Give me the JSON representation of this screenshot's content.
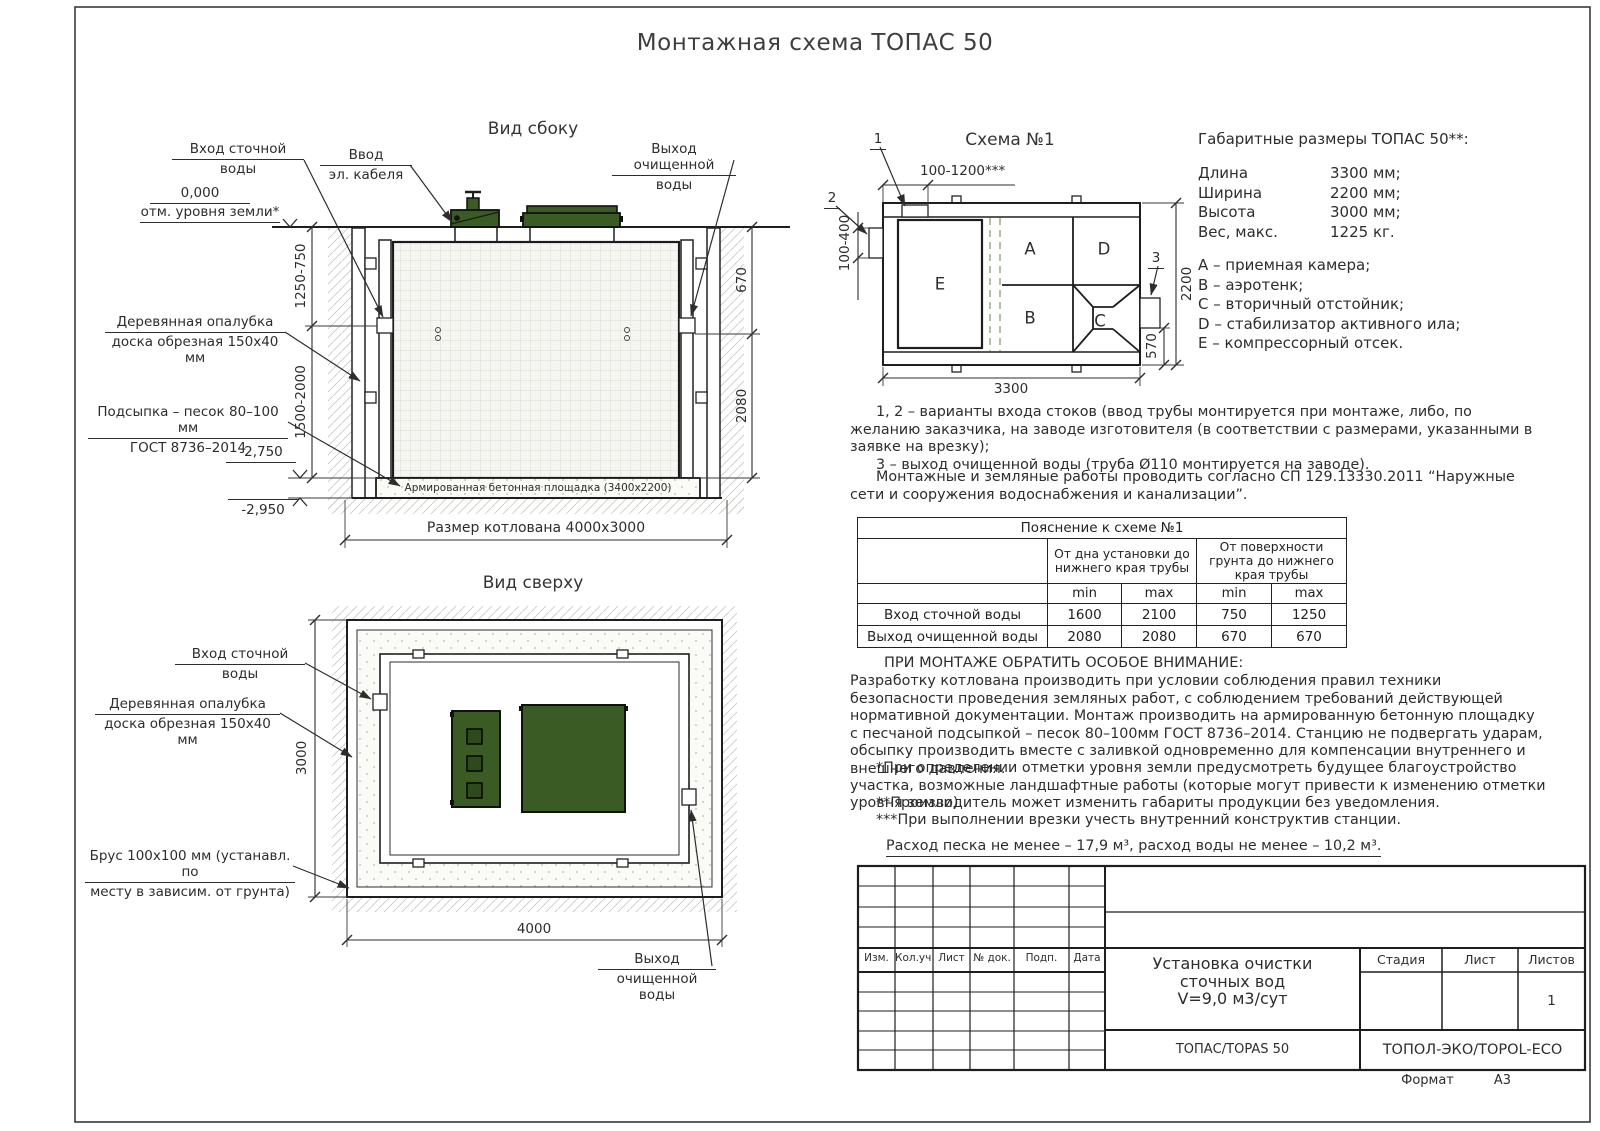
{
  "sheet": {
    "title": "Монтажная схема ТОПАС 50",
    "format_label": "Формат",
    "format_value": "А3"
  },
  "colors": {
    "lid_green": "#3b5b24",
    "lid_green_dark": "#2e4a1d",
    "line": "#2d2d2d"
  },
  "side_view": {
    "title": "Вид сбоку",
    "inlet_label_1": "Вход сточной",
    "inlet_label_2": "воды",
    "cable_label_1": "Ввод",
    "cable_label_2": "эл. кабеля",
    "outlet_label_1": "Выход очищенной",
    "outlet_label_2": "воды",
    "zero_mark": "0,000",
    "ground_mark": "отм. уровня земли*",
    "dim_depth_upper": "1250-750",
    "dim_depth_lower": "1500-2000",
    "formwork_label_1": "Деревянная опалубка",
    "formwork_label_2": "доска обрезная 150х40 мм",
    "bedding_label_1": "Подсыпка – песок 80–100 мм",
    "bedding_label_2": "ГОСТ 8736–2014",
    "elev_pad_top": "-2,750",
    "elev_pad_bottom": "-2,950",
    "dim_outlet_depth": "670",
    "dim_outlet_bottom": "2080",
    "slab_label": "Армированная бетонная площадка (3400х2200)",
    "pit_size_label": "Размер котлована 4000х3000"
  },
  "top_view": {
    "title": "Вид сверху",
    "inlet_label_1": "Вход сточной",
    "inlet_label_2": "воды",
    "formwork_label_1": "Деревянная опалубка",
    "formwork_label_2": "доска обрезная 150х40 мм",
    "beam_label_1": "Брус 100х100 мм (устанавл. по",
    "beam_label_2": "месту в зависим. от грунта)",
    "dim_width": "3000",
    "dim_length": "4000",
    "outlet_label_1": "Выход",
    "outlet_label_2": "очищенной воды"
  },
  "scheme1": {
    "title": "Схема №1",
    "callout_1": "1",
    "callout_2": "2",
    "callout_3": "3",
    "dim_inlet_offset": "100-1200***",
    "dim_inlet_height": "100-400",
    "dim_length": "3300",
    "dim_width": "2200",
    "dim_outlet": "570",
    "compartments": {
      "A": "A",
      "B": "B",
      "C": "C",
      "D": "D",
      "E": "E"
    }
  },
  "dimensions": {
    "title": "Габаритные размеры ТОПАС 50**:",
    "rows": [
      {
        "label": "Длина",
        "value": "3300 мм;"
      },
      {
        "label": "Ширина",
        "value": "2200 мм;"
      },
      {
        "label": "Высота",
        "value": "3000 мм;"
      },
      {
        "label": "Вес, макс.",
        "value": "1225 кг."
      }
    ],
    "legend": [
      "A – приемная камера;",
      "B – аэротенк;",
      "C – вторичный отстойник;",
      "D – стабилизатор активного ила;",
      "E – компрессорный отсек."
    ]
  },
  "notes": {
    "variants_1": "1, 2 – варианты входа  стоков (ввод трубы монтируется при монтаже, либо, по желанию заказчика, на заводе изготовителя (в соответствии с размерами, указанными в заявке на врезку);",
    "variants_2": "3 – выход очищенной воды (труба Ø110 монтируется на заводе).",
    "sp_note": "Монтажные и земляные работы проводить согласно СП 129.13330.2011 “Наружные сети и сооружения водоснабжения и канализации”."
  },
  "table": {
    "title": "Пояснение к схеме №1",
    "group_headers": [
      "От дна установки до нижнего края трубы",
      "От поверхности грунта до нижнего края трубы"
    ],
    "sub_headers": [
      "min",
      "max",
      "min",
      "max"
    ],
    "rows": [
      {
        "label": "Вход сточной воды",
        "values": [
          "1600",
          "2100",
          "750",
          "1250"
        ]
      },
      {
        "label": "Выход очищенной воды",
        "values": [
          "2080",
          "2080",
          "670",
          "670"
        ]
      }
    ]
  },
  "attention": {
    "heading": "ПРИ МОНТАЖЕ ОБРАТИТЬ ОСОБОЕ ВНИМАНИЕ:",
    "body": "Разработку котлована производить при условии соблюдения правил техники безопасности проведения земляных работ, с соблюдением требований действующей нормативной документации.  Монтаж производить на армированную бетонную площадку с песчаной подсыпкой – песок 80–100мм ГОСТ 8736–2014. Станцию не подвергать ударам, обсыпку производить вместе с заливкой одновременно для компенсации внутреннего и внешнего давления.",
    "note_1": "*При определении отметки уровня земли предусмотреть будущее благоустройство участка, возможные ландшафтные работы (которые могут привести к изменению отметки уровня земли).",
    "note_2": "**Производитель может изменить габариты продукции без уведомления.",
    "note_3": "***При выполнении врезки учесть внутренний конструктив станции.",
    "consumption": "Расход песка не менее – 17,9 м³, расход воды не менее – 10,2 м³."
  },
  "stamp": {
    "columns": [
      "Изм.",
      "Кол.уч.",
      "Лист",
      "№ док.",
      "Подп.",
      "Дата"
    ],
    "doc_title_1": "Установка очистки",
    "doc_title_2": "сточных вод",
    "doc_title_3": "V=9,0 м3/сут",
    "product": "ТОПАС/TOPAS 50",
    "company": "ТОПОЛ-ЭКО/TOPOL-ECO",
    "stage_label": "Стадия",
    "sheet_label": "Лист",
    "sheets_label": "Листов",
    "sheets_value": "1"
  }
}
